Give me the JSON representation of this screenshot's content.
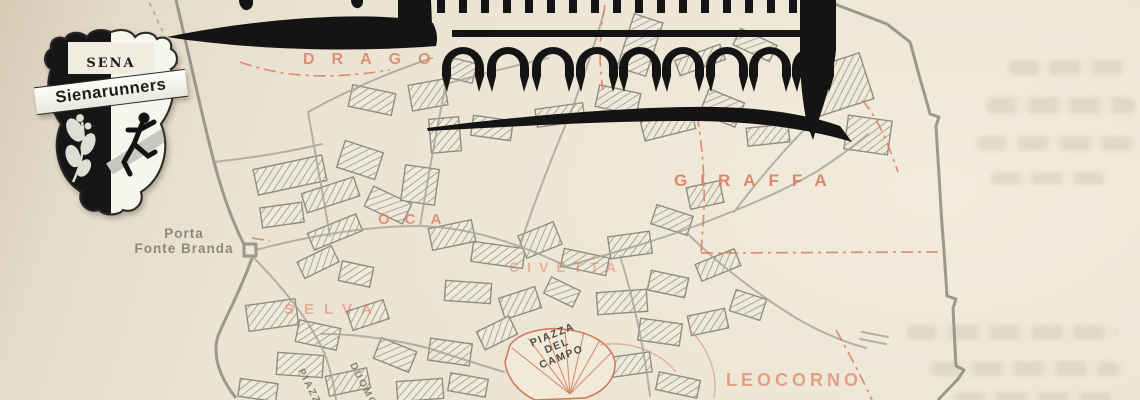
{
  "logo": {
    "sena": "SENA",
    "name": "Sienarunners"
  },
  "labels": {
    "drago": "DRAGO",
    "giraffa": "GIRAFFA",
    "oca": "OCA",
    "civetta": "CIVETTA",
    "selva": "SELVA",
    "leocorno": "LEOCORNO",
    "porta_line1": "Porta",
    "porta_line2": "Fonte Branda",
    "campo_line1": "PIAZZA",
    "campo_line2": "DEL",
    "campo_line3": "CAMPO",
    "duomo_line1": "PIAZZA",
    "duomo_line2": "DUOMO"
  },
  "colors": {
    "paper": "#ece5d4",
    "map_gray": "#a6a399",
    "contrada_salmon": "#de8166",
    "boundary_red": "#d97f63",
    "ink_black": "#141414"
  }
}
